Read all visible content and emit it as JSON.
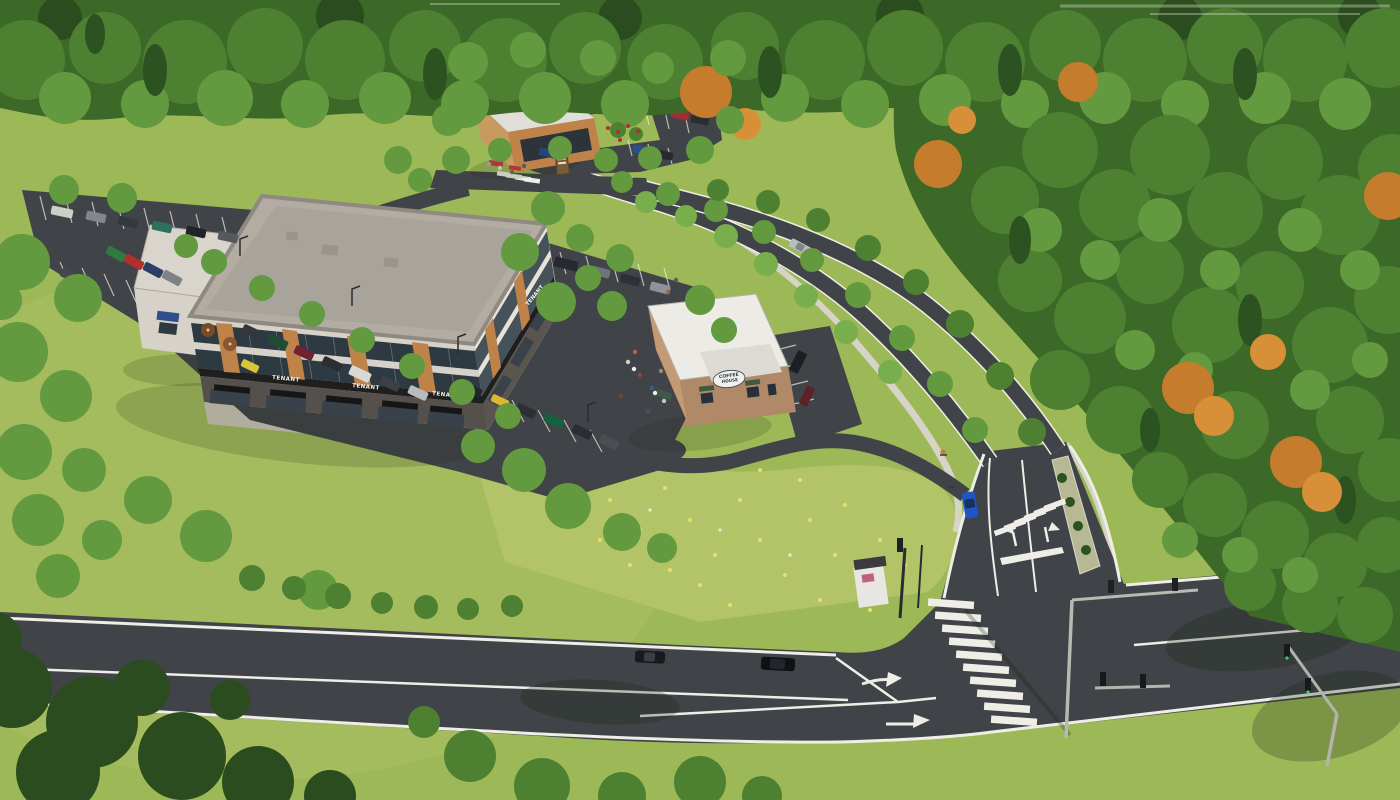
{
  "signs": {
    "tenant": "TENANT",
    "coffee_line1": "COFFEE",
    "coffee_line2": "HOUSE",
    "monument_top": "THE",
    "monument_main": "DOWNS"
  },
  "palette": {
    "grass": "#9db857",
    "meadow": "#b3c468",
    "forest": "#3c6828",
    "foliage1": "#4e8032",
    "foliage2": "#63993f",
    "foliage3": "#79ae4d",
    "conifer": "#2c5222",
    "conifer_dark": "#2b4c1e",
    "autumn1": "#c57c2c",
    "autumn2": "#d89038",
    "road": "#404347",
    "marking": "#efeee6",
    "sidewalk": "#d6d4c6",
    "pavers": "#c79f6f",
    "roof_main": "#b2aca3",
    "roof_white": "#ecebe5",
    "wall_light": "#d7d2c9",
    "wall_lighter": "#e7e3da",
    "wood": "#bf8349",
    "glass": "#2e3a42",
    "glass_light": "#46525a",
    "fascia": "#1f1f1f",
    "brick": "#b08968",
    "awning_green": "#3e5a45",
    "awning_blue": "#2f4e8c",
    "sign_gray": "#53585c",
    "car_blue": "#1e56c8"
  }
}
